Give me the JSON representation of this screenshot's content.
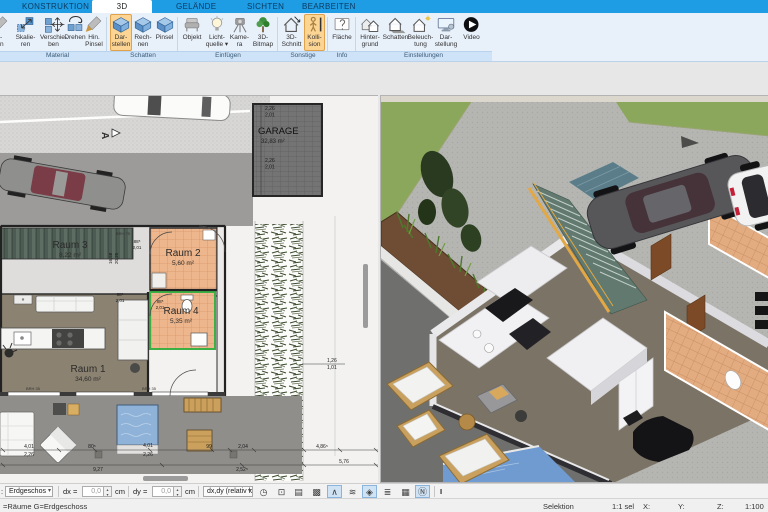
{
  "ribbon": {
    "tabs": [
      {
        "label": "KONSTRUKTION"
      },
      {
        "label": "3D"
      },
      {
        "label": "GELÄNDE"
      },
      {
        "label": "SICHTEN"
      },
      {
        "label": "BEARBEITEN"
      }
    ],
    "partial_button": {
      "l1": "r-",
      "l2": "en"
    },
    "groups": [
      {
        "label": "Material",
        "buttons": [
          {
            "l1": "Skalie-",
            "l2": "ren"
          },
          {
            "l1": "Verschie-",
            "l2": "ben"
          },
          {
            "l1": "Drehen",
            "l2": ""
          },
          {
            "l1": "Hin.",
            "l2": "Pinsel"
          }
        ]
      },
      {
        "label": "Schatten",
        "buttons": [
          {
            "l1": "Dar-",
            "l2": "stellen"
          },
          {
            "l1": "Rech-",
            "l2": "nen"
          },
          {
            "l1": "Pinsel",
            "l2": ""
          }
        ]
      },
      {
        "label": "Einfügen",
        "buttons": [
          {
            "l1": "Objekt",
            "l2": ""
          },
          {
            "l1": "Licht-",
            "l2": "quelle ▾"
          },
          {
            "l1": "Kame-",
            "l2": "ra"
          },
          {
            "l1": "3D-",
            "l2": "Bitmap"
          }
        ]
      },
      {
        "label": "Sonstige",
        "buttons": [
          {
            "l1": "3D-",
            "l2": "Schnitt"
          },
          {
            "l1": "Kolli-",
            "l2": "sion"
          }
        ]
      },
      {
        "label": "Info",
        "buttons": [
          {
            "l1": "Fläche",
            "l2": ""
          }
        ]
      },
      {
        "label": "Einstellungen",
        "buttons": [
          {
            "l1": "Hinter-",
            "l2": "grund"
          },
          {
            "l1": "Schatten",
            "l2": ""
          },
          {
            "l1": "Beleuch-",
            "l2": "tung"
          },
          {
            "l1": "Dar-",
            "l2": "stellung"
          },
          {
            "l1": "Video",
            "l2": ""
          }
        ]
      }
    ],
    "accent_orange": "#fcd494",
    "tab_blue": "#1e9ce4"
  },
  "plan": {
    "rooms": [
      {
        "name": "Raum 3",
        "area": "8,22 m²"
      },
      {
        "name": "Raum 2",
        "area": "5,60 m²"
      },
      {
        "name": "Raum 4",
        "area": "5,35 m²"
      },
      {
        "name": "Raum 1",
        "area": "34,60 m²"
      }
    ],
    "garage": {
      "name": "GARAGE",
      "area": "32,83 m²"
    },
    "section_marker": "A",
    "selection_color": "#3cb043",
    "dims": {
      "w1": "9,27",
      "w2": "2,52⁵",
      "w3": "4,86⁵",
      "w4": "5,76",
      "s1a": "4,01",
      "s1b": "2,26",
      "s2": "80⁵",
      "s3a": "4,01",
      "s3b": "2,26",
      "s4": "99",
      "s5": "2,04",
      "r1a": "1,26",
      "r1b": "1,01",
      "g1a": "2,26",
      "g1b": "2,01",
      "g2a": "2,26",
      "g2b": "2,01",
      "a1a": "88⁵",
      "a1b": "2,01",
      "a2a": "88⁵",
      "a2b": "2,01",
      "a3a": "88⁵",
      "a3b": "2,01",
      "v1a": "16,58",
      "v1b": "20,25",
      "brh1": "BRH 35",
      "brh2": "BRH 35",
      "brh3": "BRH 75"
    }
  },
  "toolbar": {
    "prefix": ":",
    "floor_select": "Erdgeschos",
    "caret": "▾",
    "spin_up": "▴",
    "spin_down": "▾",
    "dx_label": "dx =",
    "dx_value": "0,0",
    "dx_unit": "cm",
    "dy_label": "dy =",
    "dy_value": "0,0",
    "dy_unit": "cm",
    "mode_select": "dx,dy (relativ ka",
    "cursor": "I",
    "icons": [
      {
        "name": "clock-icon",
        "glyph": "◷",
        "active": false
      },
      {
        "name": "monitor-icon",
        "glyph": "⊡",
        "active": false
      },
      {
        "name": "printer-icon",
        "glyph": "▤",
        "active": false
      },
      {
        "name": "materials-icon",
        "glyph": "▩",
        "active": false
      },
      {
        "name": "roof-angle-icon",
        "glyph": "∧",
        "active": true
      },
      {
        "name": "terrain-icon",
        "glyph": "≋",
        "active": false
      },
      {
        "name": "surface-icon",
        "glyph": "◈",
        "active": true
      },
      {
        "name": "layers-icon",
        "glyph": "≣",
        "active": false
      },
      {
        "name": "grid-icon",
        "glyph": "▦",
        "active": false
      },
      {
        "name": "north-compass-icon",
        "glyph": "Ⓝ",
        "active": true
      }
    ]
  },
  "statusbar": {
    "left": "=Räume G=Erdgeschoss",
    "selection_label": "Selektion",
    "selection_value": "1:1 sel",
    "x_label": "X:",
    "y_label": "Y:",
    "z_label": "Z:",
    "scale": "1:100"
  }
}
